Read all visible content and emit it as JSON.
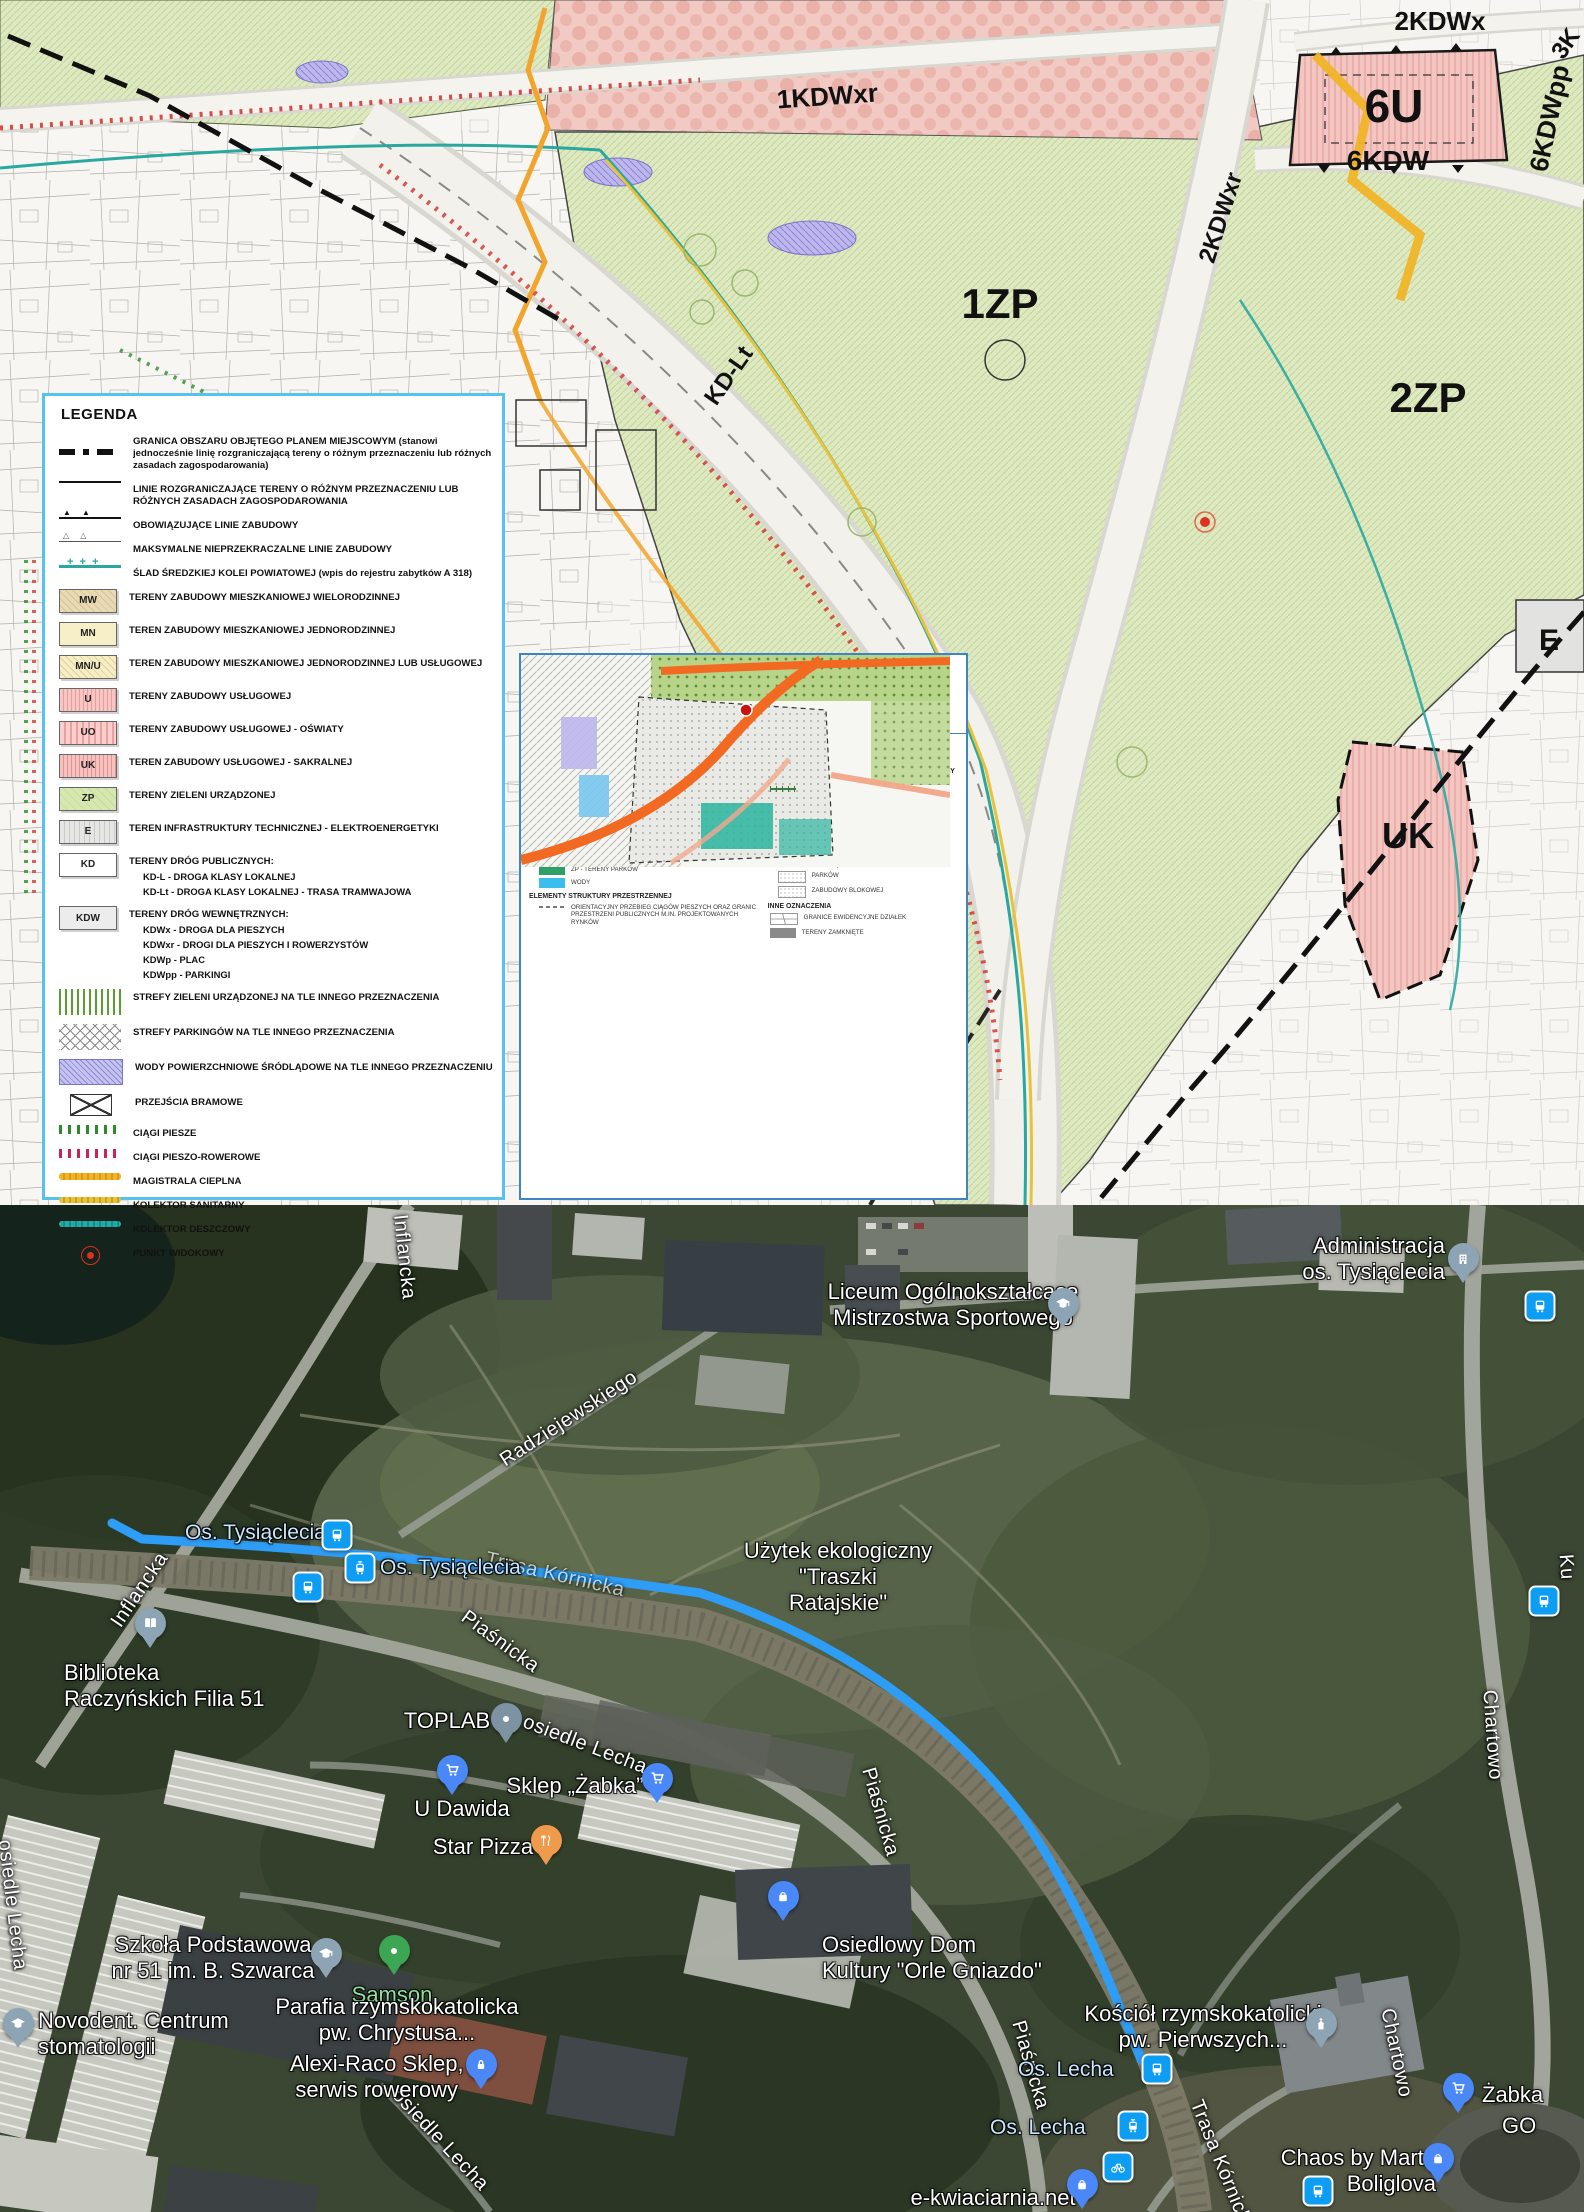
{
  "plan": {
    "zones": {
      "kdwxr1": "1KDWxr",
      "kdwx2": "2KDWx",
      "k3": "3K",
      "u6": "6U",
      "kdw6": "6KDW",
      "kdwpp6": "6KDWpp",
      "kdwxr2": "2KDWxr",
      "kdlt": "KD-Lt",
      "zp1": "1ZP",
      "zp2": "2ZP",
      "e": "E",
      "uk": "UK"
    },
    "legend": {
      "title": "LEGENDA",
      "items": [
        {
          "text": "GRANICA OBSZARU OBJĘTEGO PLANEM MIEJSCOWYM (stanowi jednocześnie linię rozgraniczającą tereny o różnym przeznaczeniu lub różnych zasadach zagospodarowania)"
        },
        {
          "text": "LINIE ROZGRANICZAJĄCE TERENY O RÓŻNYM PRZEZNACZENIU LUB RÓŻNYCH ZASADACH ZAGOSPODAROWANIA"
        },
        {
          "text": "OBOWIĄZUJĄCE LINIE ZABUDOWY"
        },
        {
          "text": "MAKSYMALNE NIEPRZEKRACZALNE LINIE ZABUDOWY"
        },
        {
          "text": "ŚLAD ŚREDZKIEJ KOLEI POWIATOWEJ (wpis do rejestru zabytków A 318)"
        },
        {
          "code": "MW",
          "text": "TERENY ZABUDOWY MIESZKANIOWEJ WIELORODZINNEJ"
        },
        {
          "code": "MN",
          "text": "TEREN ZABUDOWY MIESZKANIOWEJ JEDNORODZINNEJ"
        },
        {
          "code": "MN/U",
          "text": "TEREN ZABUDOWY MIESZKANIOWEJ JEDNORODZINNEJ LUB USŁUGOWEJ"
        },
        {
          "code": "U",
          "text": "TERENY ZABUDOWY USŁUGOWEJ"
        },
        {
          "code": "UO",
          "text": "TERENY ZABUDOWY USŁUGOWEJ - OŚWIATY"
        },
        {
          "code": "UK",
          "text": "TEREN ZABUDOWY USŁUGOWEJ - SAKRALNEJ"
        },
        {
          "code": "ZP",
          "text": "TERENY ZIELENI URZĄDZONEJ"
        },
        {
          "code": "E",
          "text": "TEREN INFRASTRUKTURY TECHNICZNEJ - ELEKTROENERGETYKI"
        },
        {
          "code": "KD",
          "text": "TERENY DRÓG PUBLICZNYCH:",
          "sub": [
            "KD-L - DROGA KLASY LOKALNEJ",
            "KD-Lt - DROGA KLASY LOKALNEJ - TRASA TRAMWAJOWA"
          ]
        },
        {
          "code": "KDW",
          "text": "TERENY DRÓG WEWNĘTRZNYCH:",
          "sub": [
            "KDWx - DROGA DLA PIESZYCH",
            "KDWxr - DROGI DLA PIESZYCH I ROWERZYSTÓW",
            "KDWp - PLAC",
            "KDWpp - PARKINGI"
          ]
        },
        {
          "text": "STREFY ZIELENI URZĄDZONEJ NA TLE INNEGO PRZEZNACZENIA"
        },
        {
          "text": "STREFY PARKINGÓW NA TLE INNEGO PRZEZNACZENIA"
        },
        {
          "text": "WODY POWIERZCHNIOWE ŚRÓDLĄDOWE NA TLE INNEGO PRZEZNACZENIU"
        },
        {
          "text": "PRZEJŚCIA BRAMOWE"
        },
        {
          "text": "CIĄGI PIESZE"
        },
        {
          "text": "CIĄGI PIESZO-ROWEROWE"
        },
        {
          "text": "MAGISTRALA CIEPLNA"
        },
        {
          "text": "KOLEKTOR SANITARNY"
        },
        {
          "text": "KOLEKTOR DESZCZOWY"
        },
        {
          "text": "PUNKT WIDOKOWY"
        }
      ]
    },
    "inset": {
      "title1": "WYRYS ZE STUDIUM UWARUNKOWAŃ I KIERUNKÓW",
      "title2": "ZAGOSPODAROWANIA PRZESTRZENNEGO MIASTA POZNANIA",
      "title3": "PRZYJĘTEGO UCHWAŁĄ NR XXXI/299/V/2008",
      "title4": "RADY MIASTA POZNANIA Z DNIA 18 STYCZNIA 2008 r.",
      "subtitle_kierunki": "KIERUNKI",
      "subtitle_skala": "SKALA 1 : 15000",
      "legend_title": "LEGENDA",
      "d1": "D1 - PODSTREFA D1",
      "granica": "GRANICA OBSZARU OBJĘTEGO MPZP",
      "sec_zabudowa": "TERENY PRZEZNACZONE POD ZABUDOWĘ",
      "mw": "Mw... - TERENY ZABUDOWY MIESZKANIOWEJ WIELORODZINNEJ,...",
      "sec_wylaczone": "TERENY WYŁĄCZONE Z ZABUDOWY",
      "zol": "ZOL - TERENY LASÓW I ZALESIEŃ",
      "zp": "ZP - TERENY PARKÓW",
      "wody": "WODY",
      "sec_elementy": "ELEMENTY STRUKTURY PRZESTRZENNEJ",
      "ciagi": "ORIENTACYJNY PRZEBIEG CIĄGÓW PIESZYCH ORAZ GRANIC PRZESTRZENI PUBLICZNYCH M.IN. PROJEKTOWANYCH RYNKÓW",
      "sec_komunikacja": "TERENY KOMUNIKACJI I URZĄDZEŃ INFRASTRUKTURY TECHNICZNEJ",
      "tory": "TORY TRAMWAJOWE",
      "drogi_rowerowe": "DROGI ROWEROWE KATEGORII I",
      "bocznice": "BOCZNICE KOLEJOWE",
      "ulice_glowne": "kG... - ULICE GŁÓWNE",
      "ulice_zbiorcze": "kZ... - ULICE ZBIORCZE",
      "tereny_tramwajowe": "kt... - WYDZIELONE TERENY TRAMWAJOWE",
      "sec_rehabilitacja": "TERENY WYMAGAJĄCE REHABILITACJI",
      "parkow": "PARKÓW",
      "zabudowy_blokowej": "ZABUDOWY BLOKOWEJ",
      "sec_inne": "INNE OZNACZENIA",
      "granice_dzialek": "GRANICE EWIDENCYJNE DZIAŁEK",
      "tereny_zamkniete": "TERENY ZAMKNIĘTE"
    }
  },
  "sat": {
    "street_inflancka": "Inflancka",
    "street_radziejewskiego": "Radziejewskiego",
    "street_piasnicka": "Piaśnicka",
    "street_osiedle_lecha": "osiedle Lecha",
    "street_chartowo": "Chartowo",
    "street_trasa_kornicka": "Trasa Kórnicka",
    "street_ku": "Ku",
    "stop_os_tysiaclecia": "Os. Tysiąclecia",
    "stop_os_lecha": "Os. Lecha",
    "poi_administracja_l1": "Administracja",
    "poi_administracja_l2": "os. Tysiąclecia",
    "poi_liceum_l1": "Liceum Ogólnokształcące",
    "poi_liceum_l2": "Mistrzostwa Sportowego",
    "poi_uzytek_l1": "Użytek ekologiczny",
    "poi_uzytek_l2": "\"Traszki",
    "poi_uzytek_l3": "Ratajskie\"",
    "poi_biblioteka_l1": "Biblioteka",
    "poi_biblioteka_l2": "Raczyńskich Filia 51",
    "poi_toplab": "TOPLAB",
    "poi_u_dawida": "U Dawida",
    "poi_sklep_zabka": "Sklep „Żabka”",
    "poi_star_pizza": "Star Pizza",
    "poi_szkola_l1": "Szkoła Podstawowa",
    "poi_szkola_l2": "nr 51 im. B. Szwarca",
    "poi_samson": "Samson",
    "poi_parafia_l1": "Parafia rzymskokatolicka",
    "poi_parafia_l2": "pw. Chrystusa...",
    "poi_novodent_l1": "Novodent. Centrum",
    "poi_novodent_l2": "stomatologii",
    "poi_alexi_l1": "Alexi-Raco Sklep,",
    "poi_alexi_l2": "serwis rowerowy",
    "poi_odk_l1": "Osiedlowy Dom",
    "poi_odk_l2": "Kultury \"Orle Gniazdo\"",
    "poi_kosciol_l1": "Kościół rzymskokatolicki",
    "poi_kosciol_l2": "pw. Pierwszych...",
    "poi_chaos_l1": "Chaos by Marta",
    "poi_chaos_l2": "Boliglova",
    "poi_zabka": "Żabka",
    "poi_zabka_go": "GO",
    "poi_ekwiaciarnia": "e-kwiaciarnia.net"
  }
}
